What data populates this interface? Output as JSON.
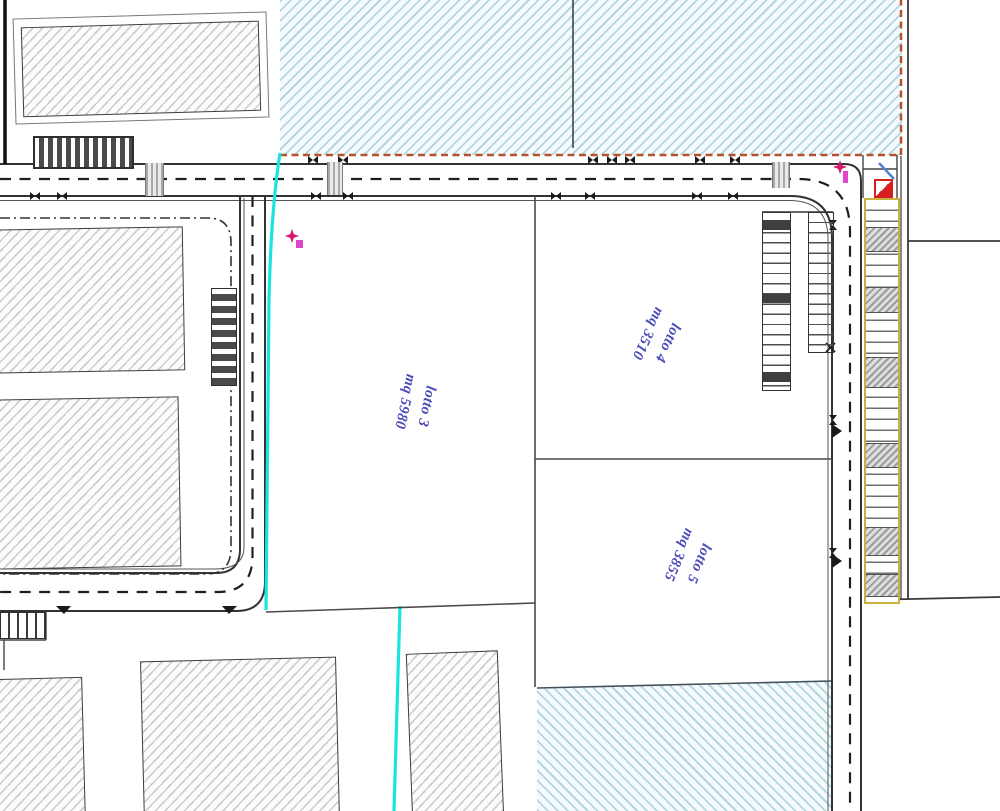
{
  "lots": [
    {
      "name": "lotto 3",
      "area": "mq 5980"
    },
    {
      "name": "lotto 4",
      "area": "mq 3510"
    },
    {
      "name": "lotto 5",
      "area": "mq 3855"
    }
  ],
  "colors": {
    "blue_zone_hatch": "#b4d7de",
    "orange_zone_boundary": "#b5512e",
    "cyan_utility_line": "#19e5df",
    "lot_label_text": "#4a4ab8",
    "magenta_survey_marker": "#d6186e",
    "yellow_parking_strip": "#c8b13e",
    "red_entry_symbol": "#d81f1f",
    "blue_entry_symbol": "#4f7fd0",
    "building_hatch": "#cdcdcd",
    "road_linework": "#333333"
  },
  "symbols": {
    "survey_marker_1": "magenta-star",
    "survey_marker_2": "magenta-star",
    "access_symbol": "red-white-diagonal-square"
  }
}
